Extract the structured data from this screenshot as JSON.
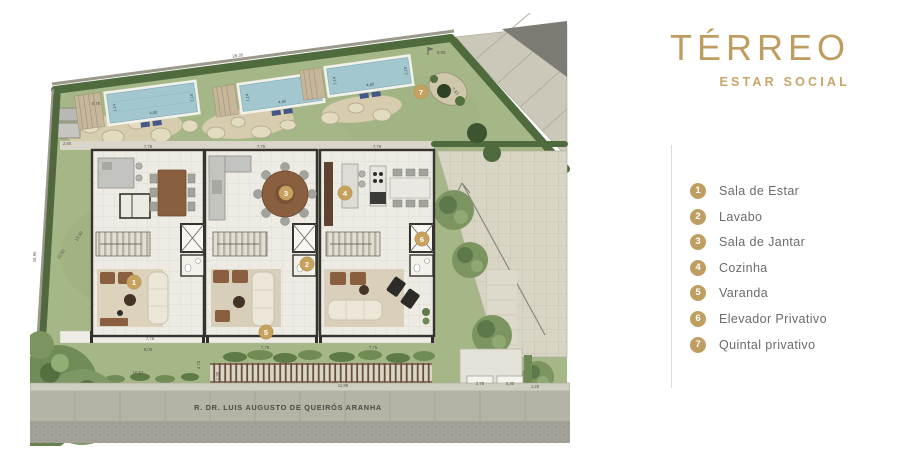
{
  "title": "TÉRREO",
  "subtitle": "ESTAR SOCIAL",
  "accent_color": "#bf9e62",
  "legend": {
    "items": [
      {
        "num": "1",
        "label": "Sala de Estar"
      },
      {
        "num": "2",
        "label": "Lavabo"
      },
      {
        "num": "3",
        "label": "Sala de Jantar"
      },
      {
        "num": "4",
        "label": "Cozinha"
      },
      {
        "num": "5",
        "label": "Varanda"
      },
      {
        "num": "6",
        "label": "Elevador Privativo"
      },
      {
        "num": "7",
        "label": "Quintal privativo"
      }
    ]
  },
  "plan": {
    "street_name": "R. DR. LUIS AUGUSTO DE QUEIRÓS ARANHA",
    "badges": {
      "b1": "1",
      "b2": "2",
      "b3": "3",
      "b4": "4",
      "b5": "5",
      "b6": "6",
      "b7": "7"
    },
    "pool": {
      "length": "4,80",
      "width": "2,10",
      "side": "1,14"
    },
    "dims": {
      "top_width": "28,35",
      "back_flag": "8,90",
      "right_diag": "7,33",
      "shed": "2,60",
      "shed_top": "0,75",
      "left_total": "16,95",
      "left_upper": "13,50",
      "left_lower": "10,50",
      "unit_width": "7,75",
      "terrace": "7,75",
      "yard_width": "8,00",
      "yard_depth": "10,52",
      "side_depth": "4,75",
      "side_small": "1,50",
      "front_width": "11,99",
      "lot_a": "2,75",
      "lot_b": "2,30",
      "lot_c": "1,20"
    }
  }
}
